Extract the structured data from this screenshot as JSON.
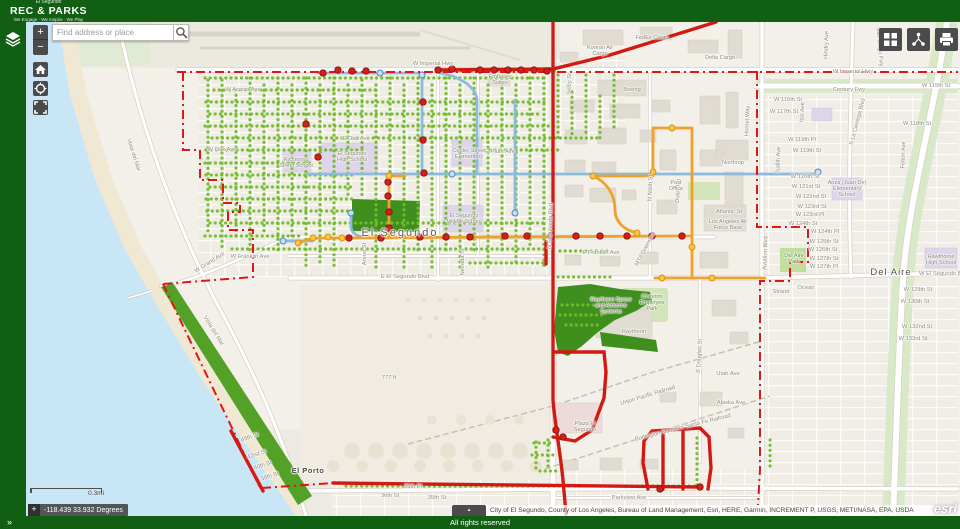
{
  "header": {
    "app_subtitle": "El Segundo",
    "app_title": "REC & PARKS",
    "tagline": "We Engage · We Inspire · We Play"
  },
  "search": {
    "placeholder": "Find address or place"
  },
  "toolbar": {
    "zoom_in": "+",
    "zoom_out": "−",
    "expand": "»",
    "attribution_toggle": "▴"
  },
  "footer": {
    "rights": "All rights reserved"
  },
  "colors": {
    "brand-green": "#115f12",
    "panel-dark": "#4b4b4b",
    "route-red": "#d31a12",
    "route-orange": "#efa22b",
    "route-blue": "#8cbade",
    "boundary-red": "#e31414",
    "tree-green": "#73bb2c",
    "park-dark": "#3e8f1e",
    "coast-green": "#54a127",
    "ocean-blue": "#c9e6f6",
    "land": "#f3f0e9"
  },
  "map": {
    "scalebar_label": "0.3mi",
    "coordinates": "-118.439 33.932 Degrees",
    "attribution": "City of El Segundo, County of Los Angeles, Bureau of Land Management, Esri, HERE, Garmin, INCREMENT P, USGS, METI/NASA, EPA, USDA",
    "esri_logo": "esri",
    "labels": [
      {
        "t": "W Imperial Hwy",
        "x": 433,
        "y": 64,
        "c": "street"
      },
      {
        "t": "W Imperial Hwy",
        "x": 853,
        "y": 72,
        "c": "street"
      },
      {
        "t": "Century Fwy",
        "x": 849,
        "y": 90,
        "c": "street"
      },
      {
        "t": "San Diego Fwy",
        "x": 879,
        "y": 47,
        "c": "street",
        "r": 85
      },
      {
        "t": "Korean Air Cargo",
        "x": 600,
        "y": 51,
        "c": "poi",
        "w": 34
      },
      {
        "t": "FedEx Cargo",
        "x": 652,
        "y": 38,
        "c": "poi",
        "w": 60
      },
      {
        "t": "Delta Cargo",
        "x": 720,
        "y": 58,
        "c": "poi",
        "w": 60
      },
      {
        "t": "Boeing",
        "x": 632,
        "y": 90,
        "c": "poi",
        "w": 40
      },
      {
        "t": "Embassy Suites",
        "x": 500,
        "y": 80,
        "c": "poi",
        "w": 30
      },
      {
        "t": "W Acacia Ave",
        "x": 243,
        "y": 90,
        "c": "street"
      },
      {
        "t": "W Oak Ave",
        "x": 222,
        "y": 150,
        "c": "street"
      },
      {
        "t": "E Oak Ave",
        "x": 356,
        "y": 139,
        "c": "street"
      },
      {
        "t": "E Palm Ave",
        "x": 500,
        "y": 152,
        "c": "street"
      },
      {
        "t": "Richmond Street School",
        "x": 296,
        "y": 163,
        "c": "poi",
        "w": 36
      },
      {
        "t": "El Segundo High School",
        "x": 352,
        "y": 157,
        "c": "poi",
        "w": 40
      },
      {
        "t": "Center Street Elementary",
        "x": 469,
        "y": 154,
        "c": "poi",
        "w": 34
      },
      {
        "t": "El Segundo Middle School",
        "x": 464,
        "y": 219,
        "c": "poi",
        "w": 38
      },
      {
        "t": "El Segundo",
        "x": 400,
        "y": 233,
        "c": "city"
      },
      {
        "t": "E Franklin Ave",
        "x": 601,
        "y": 253,
        "c": "street"
      },
      {
        "t": "W Franklin Ave",
        "x": 250,
        "y": 257,
        "c": "street"
      },
      {
        "t": "E El Segundo Blvd",
        "x": 405,
        "y": 277,
        "c": "street"
      },
      {
        "t": "Nevada St",
        "x": 463,
        "y": 262,
        "c": "street",
        "r": -90
      },
      {
        "t": "Arena St",
        "x": 365,
        "y": 254,
        "c": "street",
        "r": -90
      },
      {
        "t": "W Grand Ave",
        "x": 210,
        "y": 263,
        "c": "street",
        "r": -32
      },
      {
        "t": "Vista del Mar",
        "x": 133,
        "y": 155,
        "c": "street",
        "r": 72
      },
      {
        "t": "Vista del Mar",
        "x": 213,
        "y": 331,
        "c": "street",
        "r": 58
      },
      {
        "t": "Chevron Employee Park",
        "x": 652,
        "y": 303,
        "c": "park",
        "w": 32
      },
      {
        "t": "Raytheon Space and Airborne Systems",
        "x": 611,
        "y": 306,
        "c": "poi",
        "w": 52
      },
      {
        "t": "Raytheon",
        "x": 634,
        "y": 332,
        "c": "poi",
        "w": 40
      },
      {
        "t": "777 ft",
        "x": 389,
        "y": 378,
        "c": "street"
      },
      {
        "t": "Utah Ave",
        "x": 728,
        "y": 374,
        "c": "street"
      },
      {
        "t": "Alaska Ave",
        "x": 731,
        "y": 403,
        "c": "street"
      },
      {
        "t": "S Douglas St",
        "x": 700,
        "y": 356,
        "c": "street",
        "r": -87
      },
      {
        "t": "Duley Rd",
        "x": 679,
        "y": 191,
        "c": "street",
        "r": -85
      },
      {
        "t": "N Nash St",
        "x": 651,
        "y": 188,
        "c": "street",
        "r": -87
      },
      {
        "t": "Hornet Way",
        "x": 748,
        "y": 121,
        "c": "street",
        "r": -88
      },
      {
        "t": "Northrop",
        "x": 733,
        "y": 163,
        "c": "poi",
        "w": 44
      },
      {
        "t": "Post Office",
        "x": 676,
        "y": 186,
        "c": "poi",
        "w": 24
      },
      {
        "t": "Atlantic St",
        "x": 729,
        "y": 212,
        "c": "street"
      },
      {
        "t": "Los Angeles Air Force Base",
        "x": 728,
        "y": 225,
        "c": "poi",
        "w": 44
      },
      {
        "t": "MTA Greenline",
        "x": 646,
        "y": 249,
        "c": "street",
        "r": -62
      },
      {
        "t": "N Sepulveda Blvd",
        "x": 551,
        "y": 226,
        "c": "street",
        "r": -88
      },
      {
        "t": "Aviation Blvd",
        "x": 766,
        "y": 253,
        "c": "street",
        "r": -88
      },
      {
        "t": "Union Pacific Railroad",
        "x": 648,
        "y": 396,
        "c": "street",
        "r": -17
      },
      {
        "t": "Burlington Northern Santa Fe Railroad",
        "x": 683,
        "y": 428,
        "c": "street",
        "r": -14
      },
      {
        "t": "Plaza El Segundo",
        "x": 585,
        "y": 427,
        "c": "poi",
        "w": 30
      },
      {
        "t": "El Porto",
        "x": 308,
        "y": 471,
        "c": "city2"
      },
      {
        "t": "Parkview Ave",
        "x": 629,
        "y": 498,
        "c": "street"
      },
      {
        "t": "35th Pl",
        "x": 413,
        "y": 487,
        "c": "street"
      },
      {
        "t": "36th St",
        "x": 390,
        "y": 496,
        "c": "street"
      },
      {
        "t": "35th St",
        "x": 437,
        "y": 498,
        "c": "street"
      },
      {
        "t": "45th St",
        "x": 250,
        "y": 438,
        "c": "street",
        "r": -18
      },
      {
        "t": "42nd St",
        "x": 257,
        "y": 455,
        "c": "street",
        "r": -18
      },
      {
        "t": "40th St",
        "x": 263,
        "y": 466,
        "c": "street",
        "r": -18
      },
      {
        "t": "38th St",
        "x": 270,
        "y": 477,
        "c": "street",
        "r": -18
      },
      {
        "t": "Del Aire",
        "x": 891,
        "y": 273,
        "c": "area"
      },
      {
        "t": "Del Aire Park",
        "x": 794,
        "y": 259,
        "c": "park",
        "w": 26
      },
      {
        "t": "Anza (Juan De) Elementary School",
        "x": 847,
        "y": 189,
        "c": "poi",
        "w": 40
      },
      {
        "t": "Hawthorne High School",
        "x": 941,
        "y": 260,
        "c": "poi",
        "w": 34
      },
      {
        "t": "Strand",
        "x": 781,
        "y": 292,
        "c": "street"
      },
      {
        "t": "Ocean",
        "x": 806,
        "y": 288,
        "c": "street"
      },
      {
        "t": "W 115th St",
        "x": 936,
        "y": 86,
        "c": "street"
      },
      {
        "t": "W 116th St",
        "x": 788,
        "y": 100,
        "c": "street"
      },
      {
        "t": "W 117th St",
        "x": 784,
        "y": 112,
        "c": "street"
      },
      {
        "t": "W 118th St",
        "x": 917,
        "y": 124,
        "c": "street"
      },
      {
        "t": "W 119th Pl",
        "x": 802,
        "y": 140,
        "c": "street"
      },
      {
        "t": "W 119th St",
        "x": 807,
        "y": 151,
        "c": "street"
      },
      {
        "t": "W 120th St",
        "x": 805,
        "y": 177,
        "c": "street"
      },
      {
        "t": "W 121st St",
        "x": 806,
        "y": 187,
        "c": "street"
      },
      {
        "t": "W 122nd St",
        "x": 811,
        "y": 197,
        "c": "street"
      },
      {
        "t": "W 123rd St",
        "x": 812,
        "y": 207,
        "c": "street"
      },
      {
        "t": "W 123rd Pl",
        "x": 810,
        "y": 215,
        "c": "street"
      },
      {
        "t": "W 124th St",
        "x": 803,
        "y": 224,
        "c": "street"
      },
      {
        "t": "W 124th Pl",
        "x": 825,
        "y": 232,
        "c": "street"
      },
      {
        "t": "W 125th St",
        "x": 824,
        "y": 242,
        "c": "street"
      },
      {
        "t": "W 126th St",
        "x": 823,
        "y": 250,
        "c": "street"
      },
      {
        "t": "W 127th St",
        "x": 824,
        "y": 259,
        "c": "street"
      },
      {
        "t": "W 127th Pl",
        "x": 824,
        "y": 267,
        "c": "street"
      },
      {
        "t": "W El Segundo Blvd",
        "x": 944,
        "y": 274,
        "c": "street"
      },
      {
        "t": "W 129th St",
        "x": 918,
        "y": 290,
        "c": "street"
      },
      {
        "t": "W 130th St",
        "x": 915,
        "y": 302,
        "c": "street"
      },
      {
        "t": "W 132nd St",
        "x": 917,
        "y": 327,
        "c": "street"
      },
      {
        "t": "W 133rd St",
        "x": 913,
        "y": 339,
        "c": "street"
      },
      {
        "t": "Judith Ave",
        "x": 779,
        "y": 160,
        "c": "street",
        "r": -88
      },
      {
        "t": "Isis Ave",
        "x": 803,
        "y": 112,
        "c": "street",
        "r": -88
      },
      {
        "t": "Felton Ave",
        "x": 904,
        "y": 155,
        "c": "street",
        "r": -88
      },
      {
        "t": "S La Cienega Blvd",
        "x": 858,
        "y": 122,
        "c": "street",
        "r": -75
      },
      {
        "t": "Hindry Ave",
        "x": 827,
        "y": 45,
        "c": "street",
        "r": -88
      },
      {
        "t": "Selby St",
        "x": 570,
        "y": 84,
        "c": "street",
        "r": -88
      }
    ],
    "tree_streets": {
      "h": [
        [
          71,
          440,
          556
        ],
        [
          78,
          205,
          548
        ],
        [
          90,
          214,
          380
        ],
        [
          102,
          206,
          546
        ],
        [
          114,
          210,
          538
        ],
        [
          126,
          205,
          556
        ],
        [
          138,
          212,
          600
        ],
        [
          150,
          206,
          362
        ],
        [
          150,
          490,
          558
        ],
        [
          163,
          205,
          312
        ],
        [
          175,
          206,
          352
        ],
        [
          187,
          210,
          352
        ],
        [
          199,
          206,
          352
        ],
        [
          211,
          207,
          350
        ],
        [
          223,
          210,
          546
        ],
        [
          236,
          205,
          300
        ],
        [
          249,
          232,
          546
        ],
        [
          251,
          560,
          610
        ],
        [
          263,
          470,
          545
        ],
        [
          277,
          558,
          614
        ],
        [
          305,
          562,
          598
        ],
        [
          315,
          560,
          602
        ],
        [
          325,
          566,
          602
        ],
        [
          443,
          534,
          552
        ],
        [
          455,
          532,
          556
        ],
        [
          471,
          540,
          556
        ],
        [
          486,
          346,
          700
        ]
      ],
      "v": [
        [
          208,
          80,
          233
        ],
        [
          222,
          80,
          248
        ],
        [
          236,
          90,
          240
        ],
        [
          250,
          78,
          250
        ],
        [
          264,
          85,
          233
        ],
        [
          278,
          78,
          250
        ],
        [
          292,
          85,
          246
        ],
        [
          306,
          78,
          268
        ],
        [
          320,
          85,
          264
        ],
        [
          334,
          78,
          268
        ],
        [
          348,
          85,
          198
        ],
        [
          362,
          80,
          196
        ],
        [
          376,
          85,
          270
        ],
        [
          390,
          78,
          175
        ],
        [
          404,
          85,
          270
        ],
        [
          418,
          78,
          250
        ],
        [
          432,
          85,
          268
        ],
        [
          446,
          78,
          250
        ],
        [
          460,
          85,
          270
        ],
        [
          474,
          78,
          250
        ],
        [
          488,
          85,
          268
        ],
        [
          502,
          78,
          250
        ],
        [
          516,
          85,
          266
        ],
        [
          530,
          78,
          248
        ],
        [
          544,
          78,
          266
        ],
        [
          558,
          75,
          140
        ],
        [
          572,
          92,
          138
        ],
        [
          586,
          75,
          136
        ],
        [
          600,
          96,
          140
        ],
        [
          614,
          75,
          130
        ],
        [
          697,
          438,
          486
        ],
        [
          770,
          440,
          468
        ],
        [
          536,
          442,
          468
        ],
        [
          548,
          440,
          470
        ]
      ]
    },
    "markers": {
      "red": [
        [
          323,
          73
        ],
        [
          338,
          70
        ],
        [
          352,
          71
        ],
        [
          366,
          71
        ],
        [
          438,
          70
        ],
        [
          452,
          69
        ],
        [
          480,
          70
        ],
        [
          494,
          70
        ],
        [
          508,
          70
        ],
        [
          521,
          70
        ],
        [
          534,
          70
        ],
        [
          547,
          71
        ],
        [
          423,
          102
        ],
        [
          423,
          140
        ],
        [
          424,
          173
        ],
        [
          388,
          182
        ],
        [
          388,
          196
        ],
        [
          389,
          212
        ],
        [
          389,
          228
        ],
        [
          306,
          124
        ],
        [
          318,
          157
        ],
        [
          349,
          238
        ],
        [
          381,
          238
        ],
        [
          420,
          237
        ],
        [
          446,
          237
        ],
        [
          470,
          237
        ],
        [
          505,
          236
        ],
        [
          527,
          236
        ],
        [
          551,
          236
        ],
        [
          576,
          236
        ],
        [
          600,
          236
        ],
        [
          627,
          236
        ],
        [
          652,
          236
        ],
        [
          682,
          236
        ],
        [
          556,
          430
        ],
        [
          563,
          437
        ],
        [
          660,
          489
        ],
        [
          700,
          487
        ]
      ],
      "orange": [
        [
          298,
          243
        ],
        [
          313,
          238
        ],
        [
          328,
          237
        ],
        [
          342,
          238
        ],
        [
          389,
          176
        ],
        [
          593,
          176
        ],
        [
          637,
          233
        ],
        [
          653,
          172
        ],
        [
          672,
          128
        ],
        [
          692,
          247
        ],
        [
          662,
          278
        ],
        [
          712,
          278
        ]
      ],
      "blue": [
        [
          380,
          73
        ],
        [
          422,
          75
        ],
        [
          452,
          174
        ],
        [
          515,
          213
        ],
        [
          351,
          213
        ],
        [
          283,
          241
        ],
        [
          818,
          172
        ]
      ]
    }
  }
}
